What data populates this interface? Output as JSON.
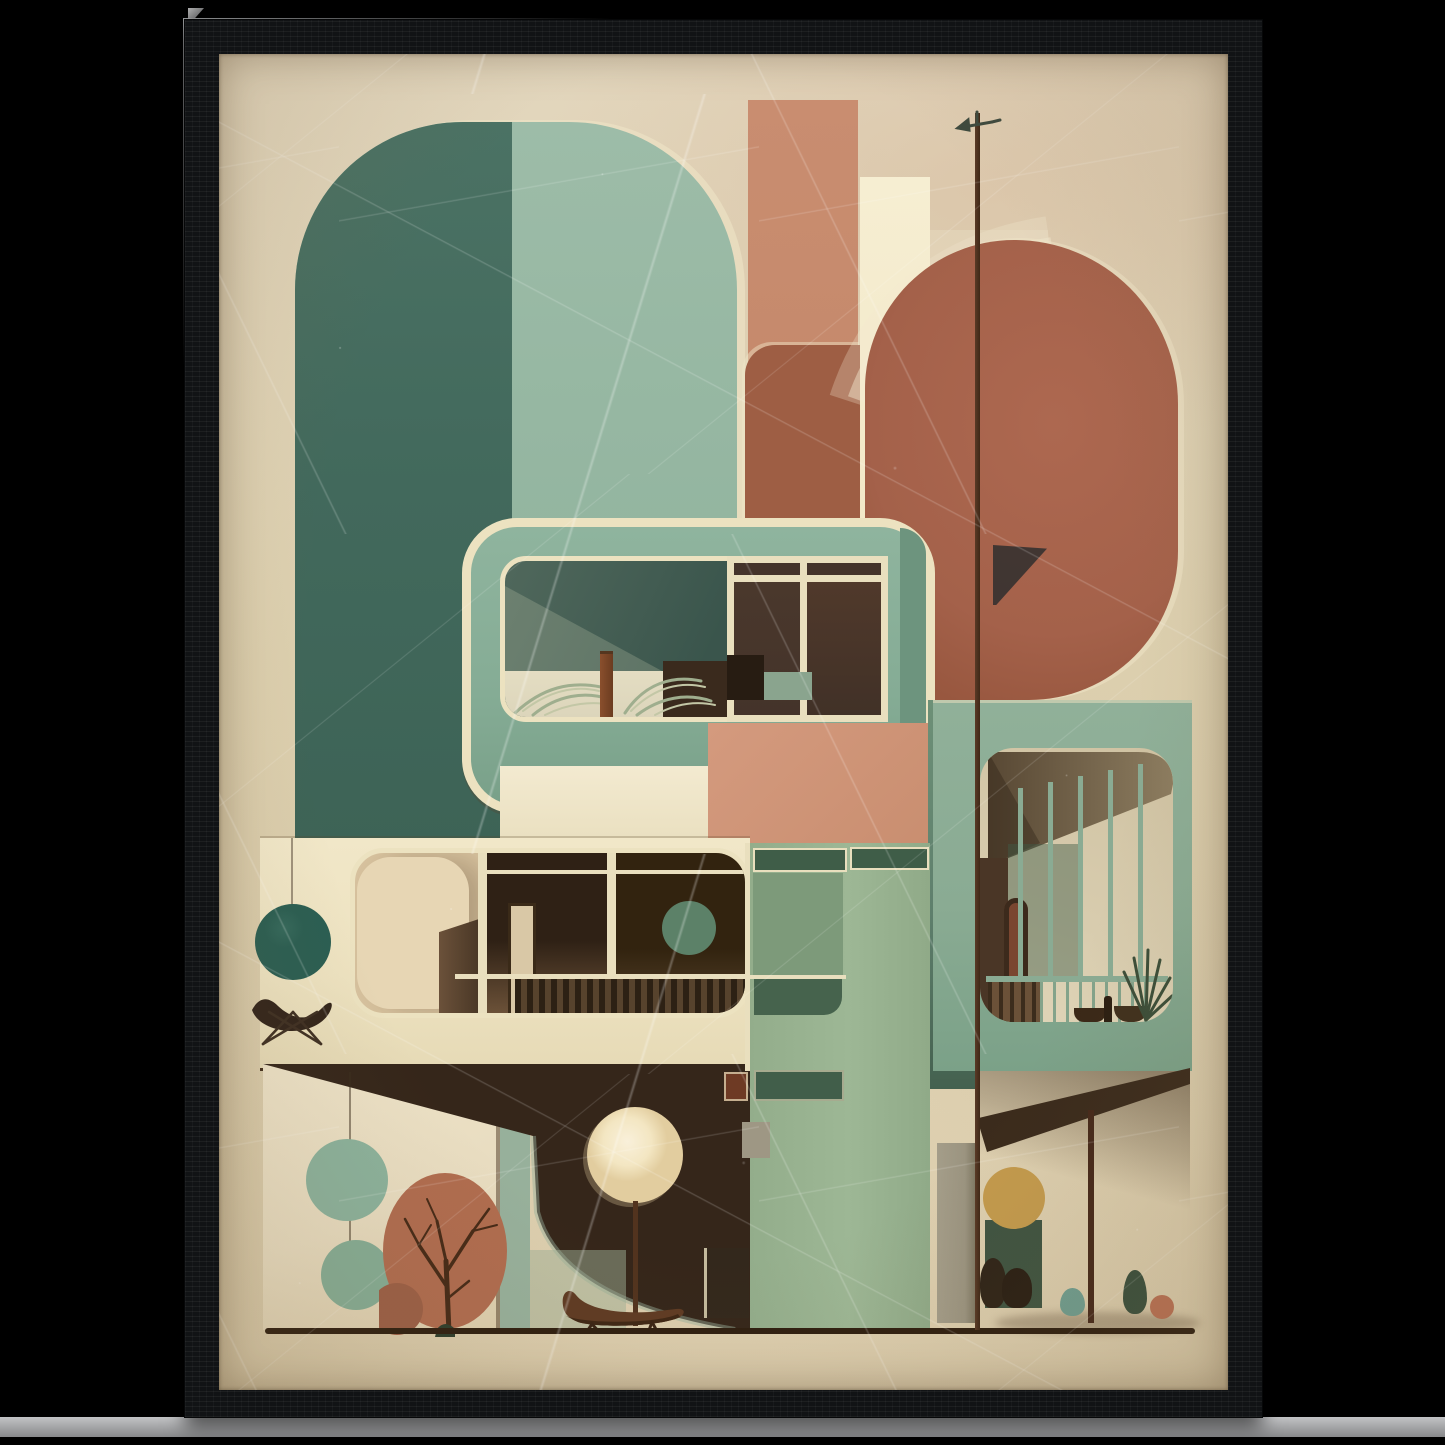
{
  "palette": {
    "background": "#000000",
    "frame_wood": "#111315",
    "frame_highlight": "#96989a",
    "stand_strip": "#a7a8aa",
    "poster_bg": "#dccfae",
    "poster_bg_light": "#e3d7be",
    "arch_teal_dark": "#42695c",
    "arch_teal_light": "#96b7a2",
    "cream_rim": "#ece2c0",
    "salmon_bar": "#c4886a",
    "rust_panel": "#9e5e44",
    "rust_circle": "#a4614a",
    "salmon_square": "#c98e70",
    "cream_bar": "#f2e8c8",
    "balcony_teal": "#85ac95",
    "balcony_teal_dark": "#6d947e",
    "interior1_dark": "#3a554c",
    "sill_cream": "#dcd5bb",
    "pane_brown": "#44332a",
    "pane_dark": "#271c12",
    "pane_sage": "#8aa48e",
    "mullion_cream": "#e9dfbe",
    "slab_cream": "#ede2c0",
    "ball_teal": "#2b5e52",
    "interior2_light": "#e7d6b4",
    "interior2_mid": "#d9c4a0",
    "interior2_dark": "#3a2a1c",
    "door_brown": "#4d3926",
    "wall_circle_sage": "#5c8168",
    "rail_dark": "#2d2114",
    "rail_mid": "#57432d",
    "tower_sage": "#9db795",
    "tower_pane_dark": "#3f5d48",
    "tower_pane_mid": "#7d9a7a",
    "box_sage": "#8aab93",
    "box_shade": "#5e7f6c",
    "box_interior": "#d8ccae",
    "ceiling_khaki": "#7c6c4f",
    "mass_brown": "#35261a",
    "wall_panel": "#e8dcc0",
    "sage_band": "#97b09b",
    "circle_sage": "#8cb29c",
    "tree_rust": "#b06c4f",
    "branch_brown": "#462a17",
    "tree_rust_dark": "#9c5f46",
    "moon_cream": "#f3e6c2",
    "chair_brown": "#5f3b23",
    "ochre": "#c39a4d",
    "bush_dark_green": "#3f5441",
    "teardrop_teal": "#6f9d8f",
    "teardrop_dark": "#3a4f3c",
    "berry_rust": "#b97154",
    "concrete_gray": "#9b9480",
    "pole_brown": "#3f2817",
    "floor_line": "#2f1f10",
    "vane_dark": "#3e4a3e"
  },
  "scene": {
    "subject": "framed mid-century modern architecture art print",
    "objects": [
      "black-wood-frame",
      "aged-poster",
      "teal-arch",
      "salmon-pillar",
      "rust-panel",
      "cream-pillar",
      "terracotta-circle",
      "weathervane-pole",
      "teal-balcony-frame",
      "palm-planter",
      "window-grid",
      "cream-slab-balcony",
      "hanging-teal-ball",
      "butterfly-chair",
      "sage-tower",
      "right-balcony-box",
      "balcony-railing",
      "potted-plant",
      "sage-circles",
      "autumn-tree",
      "moon-floor-lamp",
      "lounge-chair",
      "ochre-shrub",
      "garden-teardrops",
      "ground-line"
    ]
  }
}
